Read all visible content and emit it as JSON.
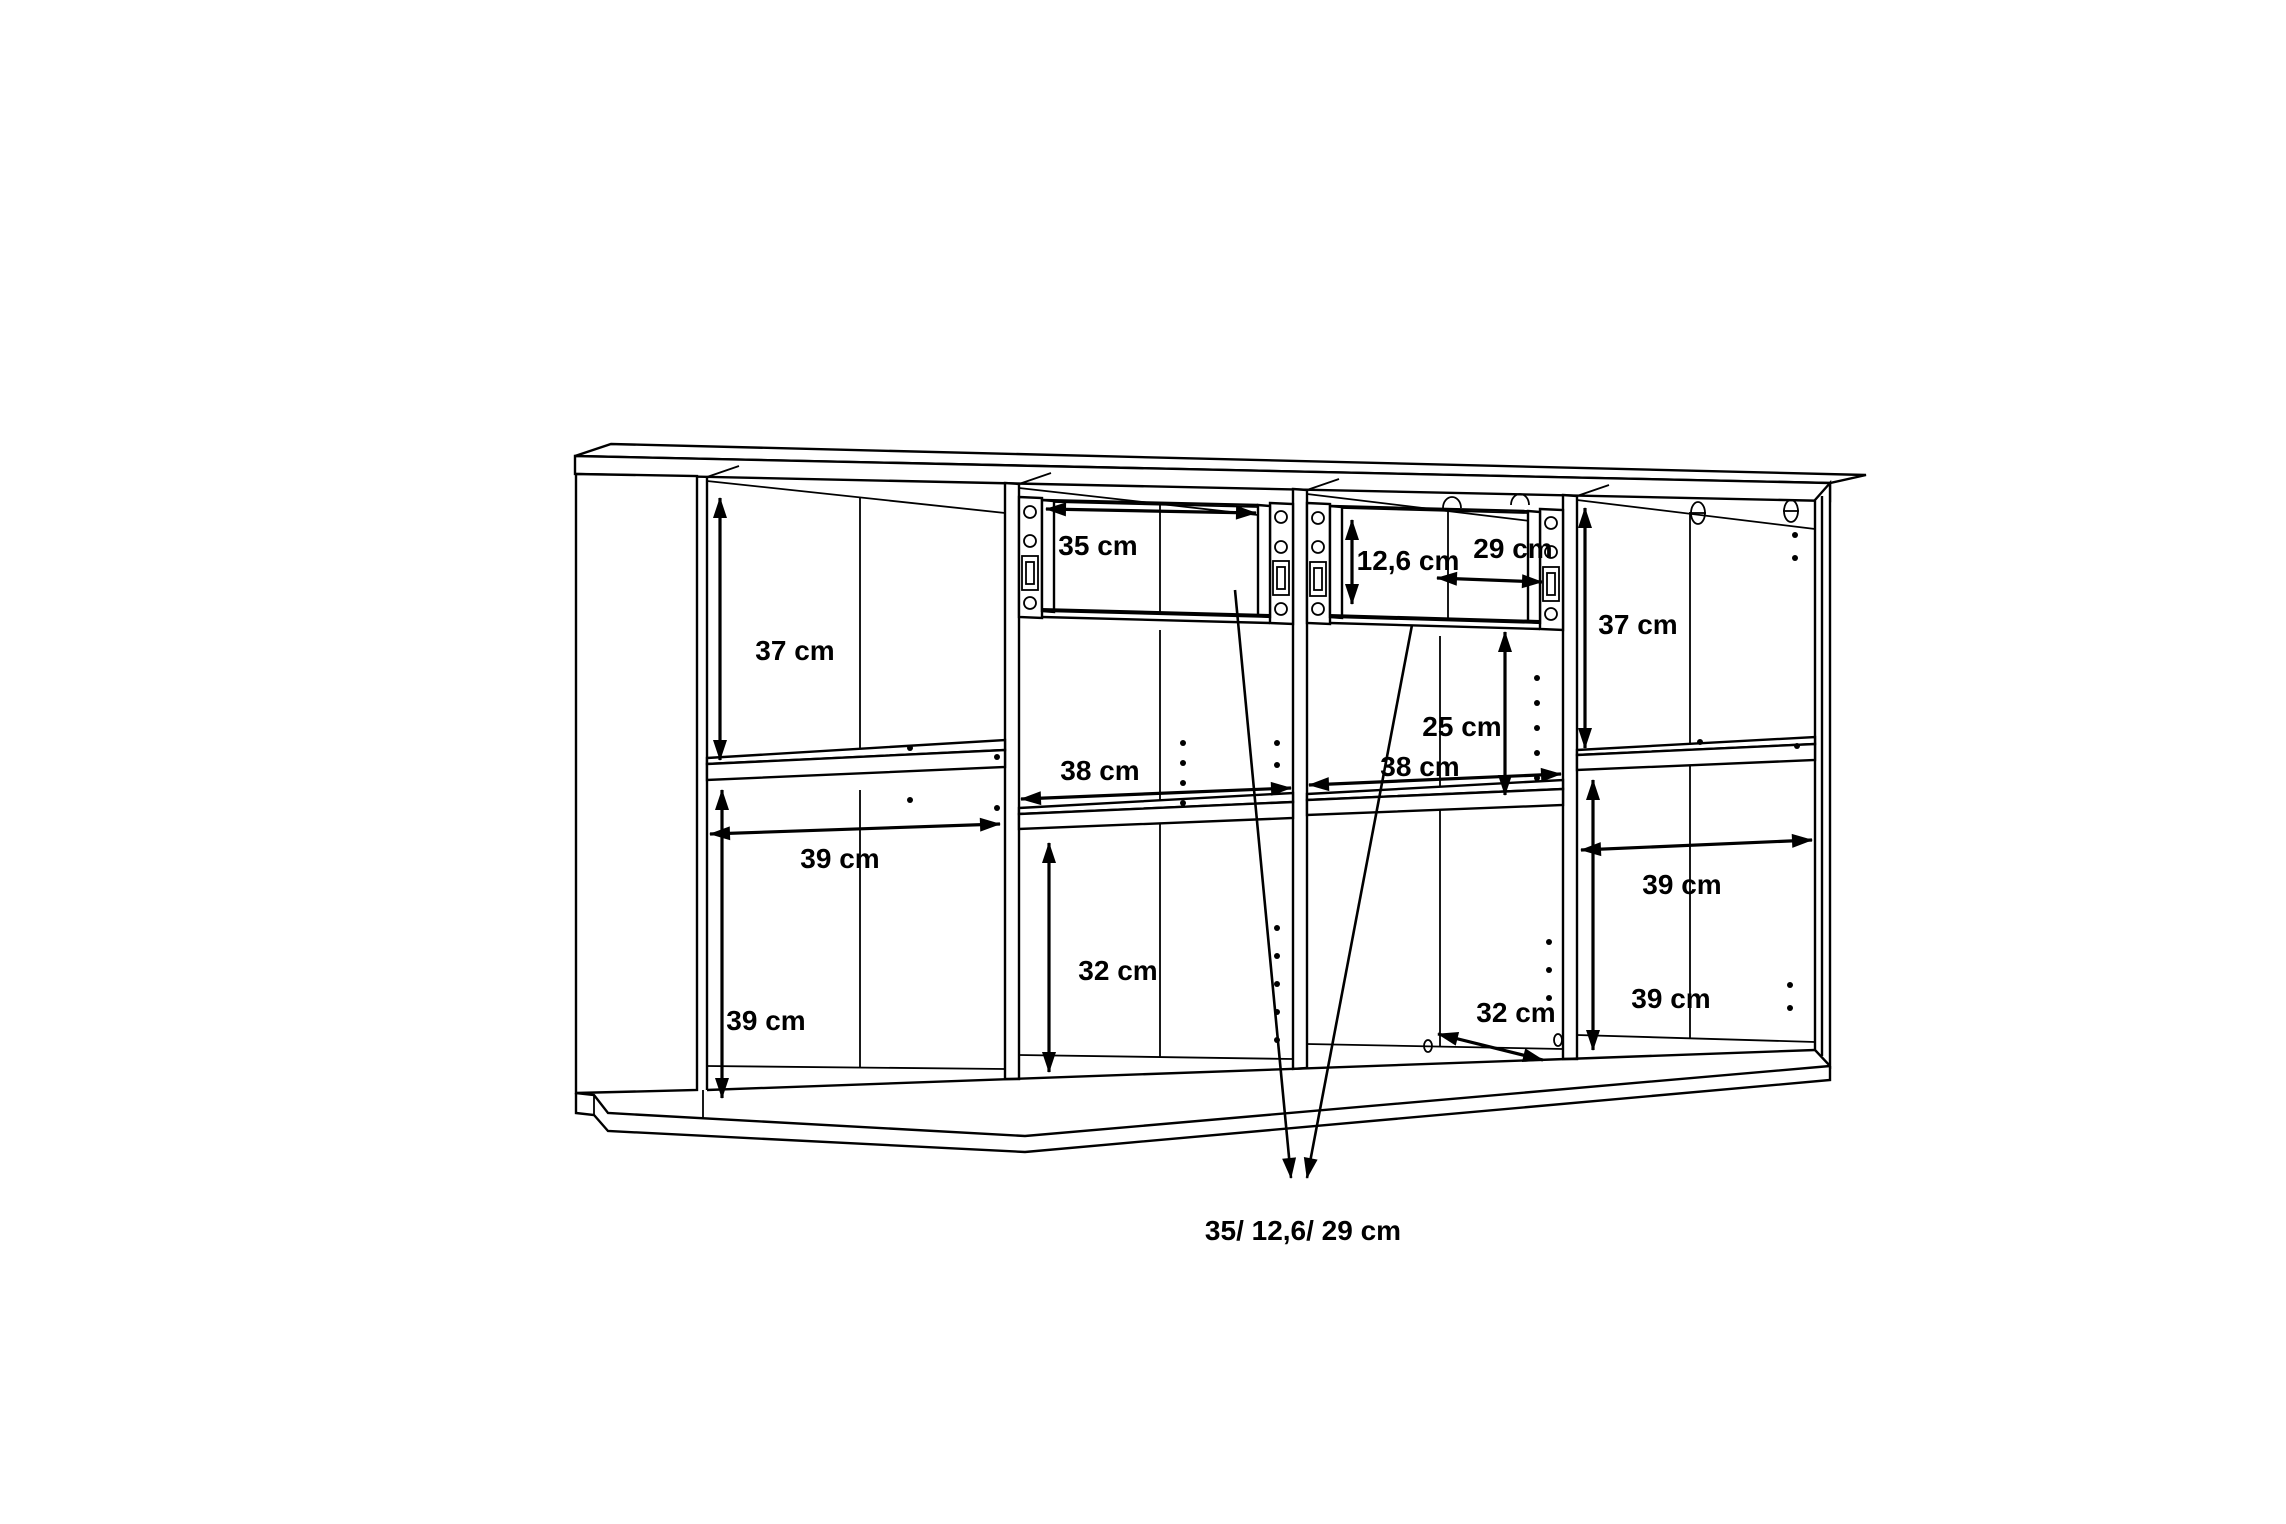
{
  "unit": "cm",
  "colors": {
    "line": "#000000",
    "background": "#ffffff"
  },
  "labels": {
    "c1_top_height": {
      "text": "37 cm"
    },
    "c1_width": {
      "text": "39 cm"
    },
    "c1_bottom_height": {
      "text": "39 cm"
    },
    "drawer1_width": {
      "text": "35 cm"
    },
    "drawer2_height": {
      "text": "12,6 cm"
    },
    "drawer2_width": {
      "text": "29 cm"
    },
    "c2_width": {
      "text": "38 cm"
    },
    "c2_bottom_height": {
      "text": "32 cm"
    },
    "c3_width": {
      "text": "38 cm"
    },
    "c3_clearance": {
      "text": "25 cm"
    },
    "c3_depth": {
      "text": "32 cm"
    },
    "c4_top_height": {
      "text": "37 cm"
    },
    "c4_width": {
      "text": "39 cm"
    },
    "c4_bottom_height": {
      "text": "39 cm"
    },
    "drawer_summary": {
      "text": "35/ 12,6/ 29 cm"
    }
  }
}
